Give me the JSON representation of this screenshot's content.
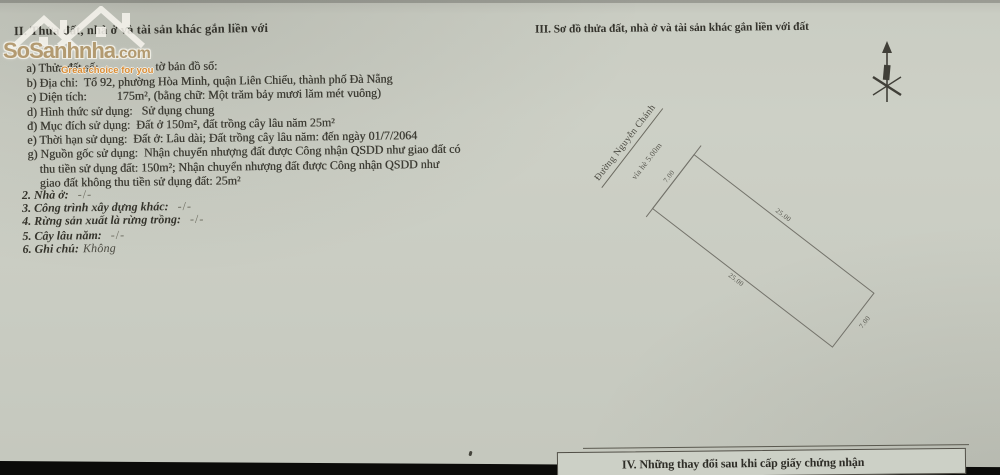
{
  "watermark": {
    "brand": "SoSanhnha",
    "brand_suffix": ".com",
    "tagline": "Great choice for you"
  },
  "section2": {
    "heading": "II. Thửa đất, nhà ở và tài sản khác gắn liền với",
    "lines": [
      "a) Thửa đất số:                 , tờ bản đồ số:",
      "b) Địa chỉ:  Tổ 92, phường Hòa Minh, quận Liên Chiểu, thành phố Đà Nẵng",
      "c) Diện tích:          175m², (bằng chữ: Một trăm bảy mươi lăm mét vuông)",
      "d) Hình thức sử dụng:   Sử dụng chung",
      "đ) Mục đích sử dụng:  Đất ở 150m², đất trồng cây lâu năm 25m²",
      "e) Thời hạn sử dụng:  Đất ở: Lâu dài; Đất trồng cây lâu năm: đến ngày 01/7/2064",
      "g) Nguồn gốc sử dụng:  Nhận chuyển nhượng đất được Công nhận QSDD như giao đất có",
      "thu tiền sử dụng đất: 150m²; Nhận chuyển nhượng đất được Công nhận QSDD như",
      "giao đất không thu tiền sử dụng đất: 25m²"
    ],
    "items": [
      {
        "label": "2. Nhà ở:",
        "value": "-/-"
      },
      {
        "label": "3. Công trình xây dựng khác:",
        "value": "-/-"
      },
      {
        "label": "4. Rừng sản xuất là rừng trồng:",
        "value": "-/-"
      },
      {
        "label": "5. Cây lâu năm:",
        "value": "-/-"
      },
      {
        "label": "6. Ghi chú:",
        "value": "Không"
      }
    ]
  },
  "section3": {
    "heading": "III. Sơ đồ thửa đất, nhà ở và tài sản khác gắn liền với đất",
    "diagram": {
      "street_name": "Đường Nguyễn Chánh",
      "sidewalk_label": "vỉa hè 5.00m",
      "dim_front": "7.00",
      "dim_rear": "7.00",
      "dim_side_top": "25.00",
      "dim_side_bottom": "25.00"
    }
  },
  "section4": {
    "heading": "IV. Những thay đổi sau khi cấp giấy chứng nhận"
  },
  "colors": {
    "paper": "#cacdc3",
    "ink": "#3c3b33",
    "watermark_brand": "#b2976b",
    "watermark_tagline": "#de8c31",
    "photo_edge": "#0b0b09"
  }
}
